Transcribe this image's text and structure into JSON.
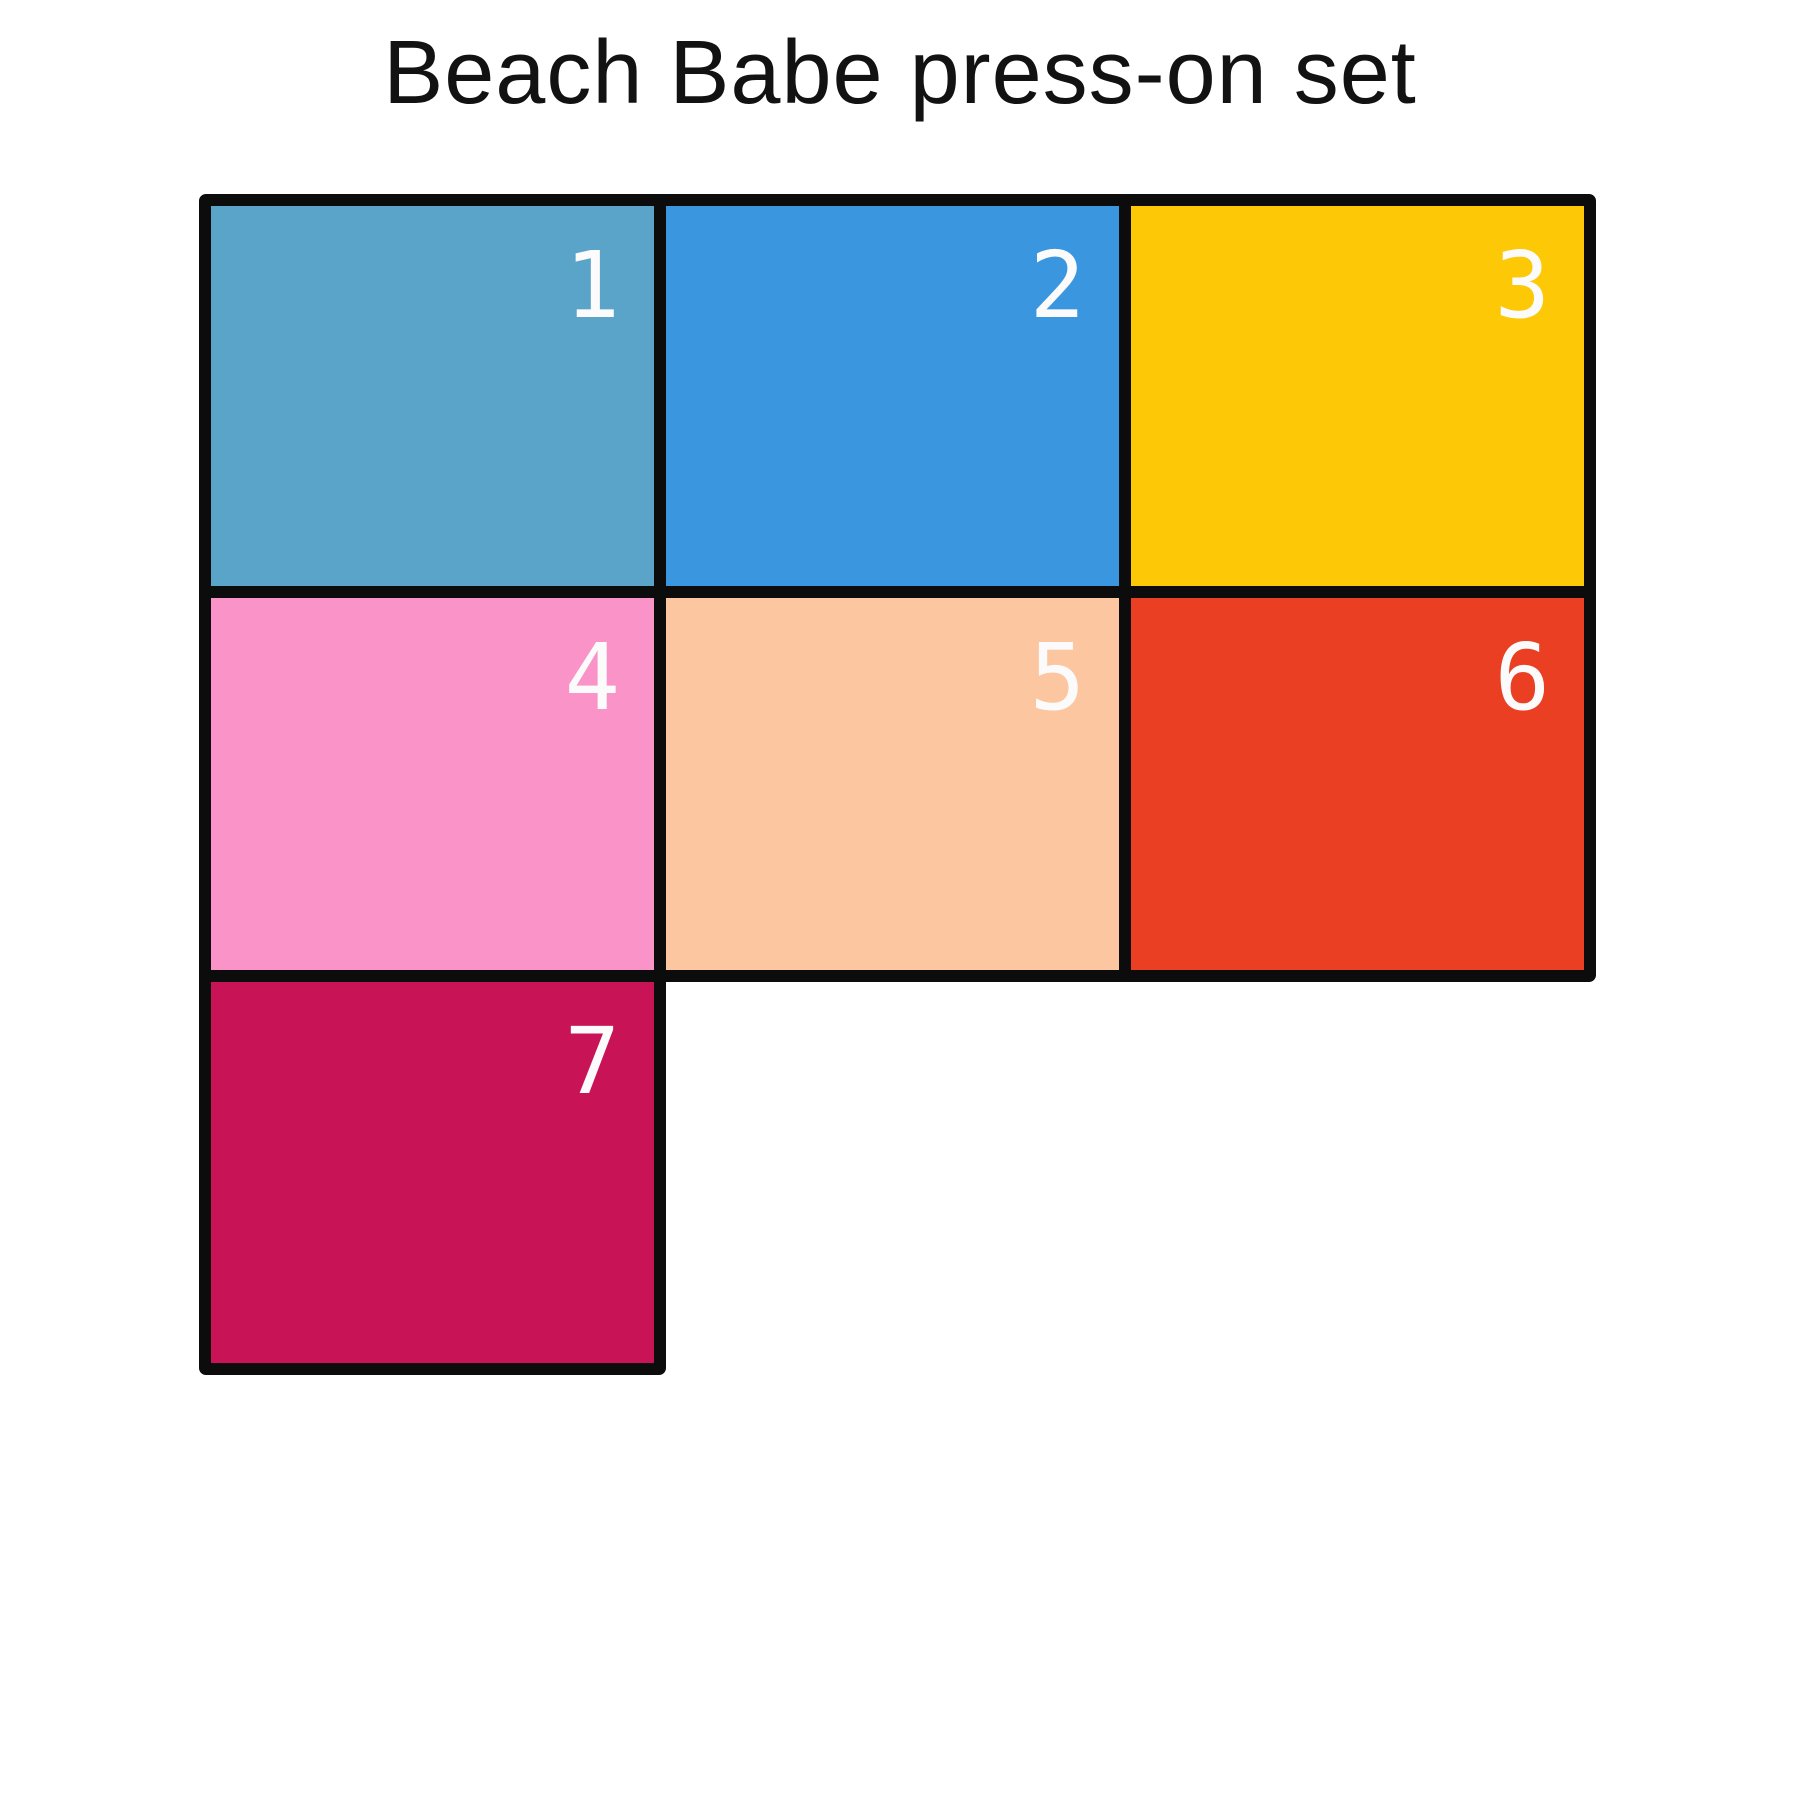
{
  "title": "Beach Babe press-on set",
  "colors": {
    "background": "#ffffff",
    "title_text": "#121212",
    "border": "#0c0c0c",
    "number_text": "#fbfbfb"
  },
  "swatches": [
    {
      "number": "1",
      "color": "#5aa3c9"
    },
    {
      "number": "2",
      "color": "#3b96e0"
    },
    {
      "number": "3",
      "color": "#fdc806"
    },
    {
      "number": "4",
      "color": "#fa93c8"
    },
    {
      "number": "5",
      "color": "#fcc7a0"
    },
    {
      "number": "6",
      "color": "#ea3f23"
    },
    {
      "number": "7",
      "color": "#c81357"
    }
  ]
}
